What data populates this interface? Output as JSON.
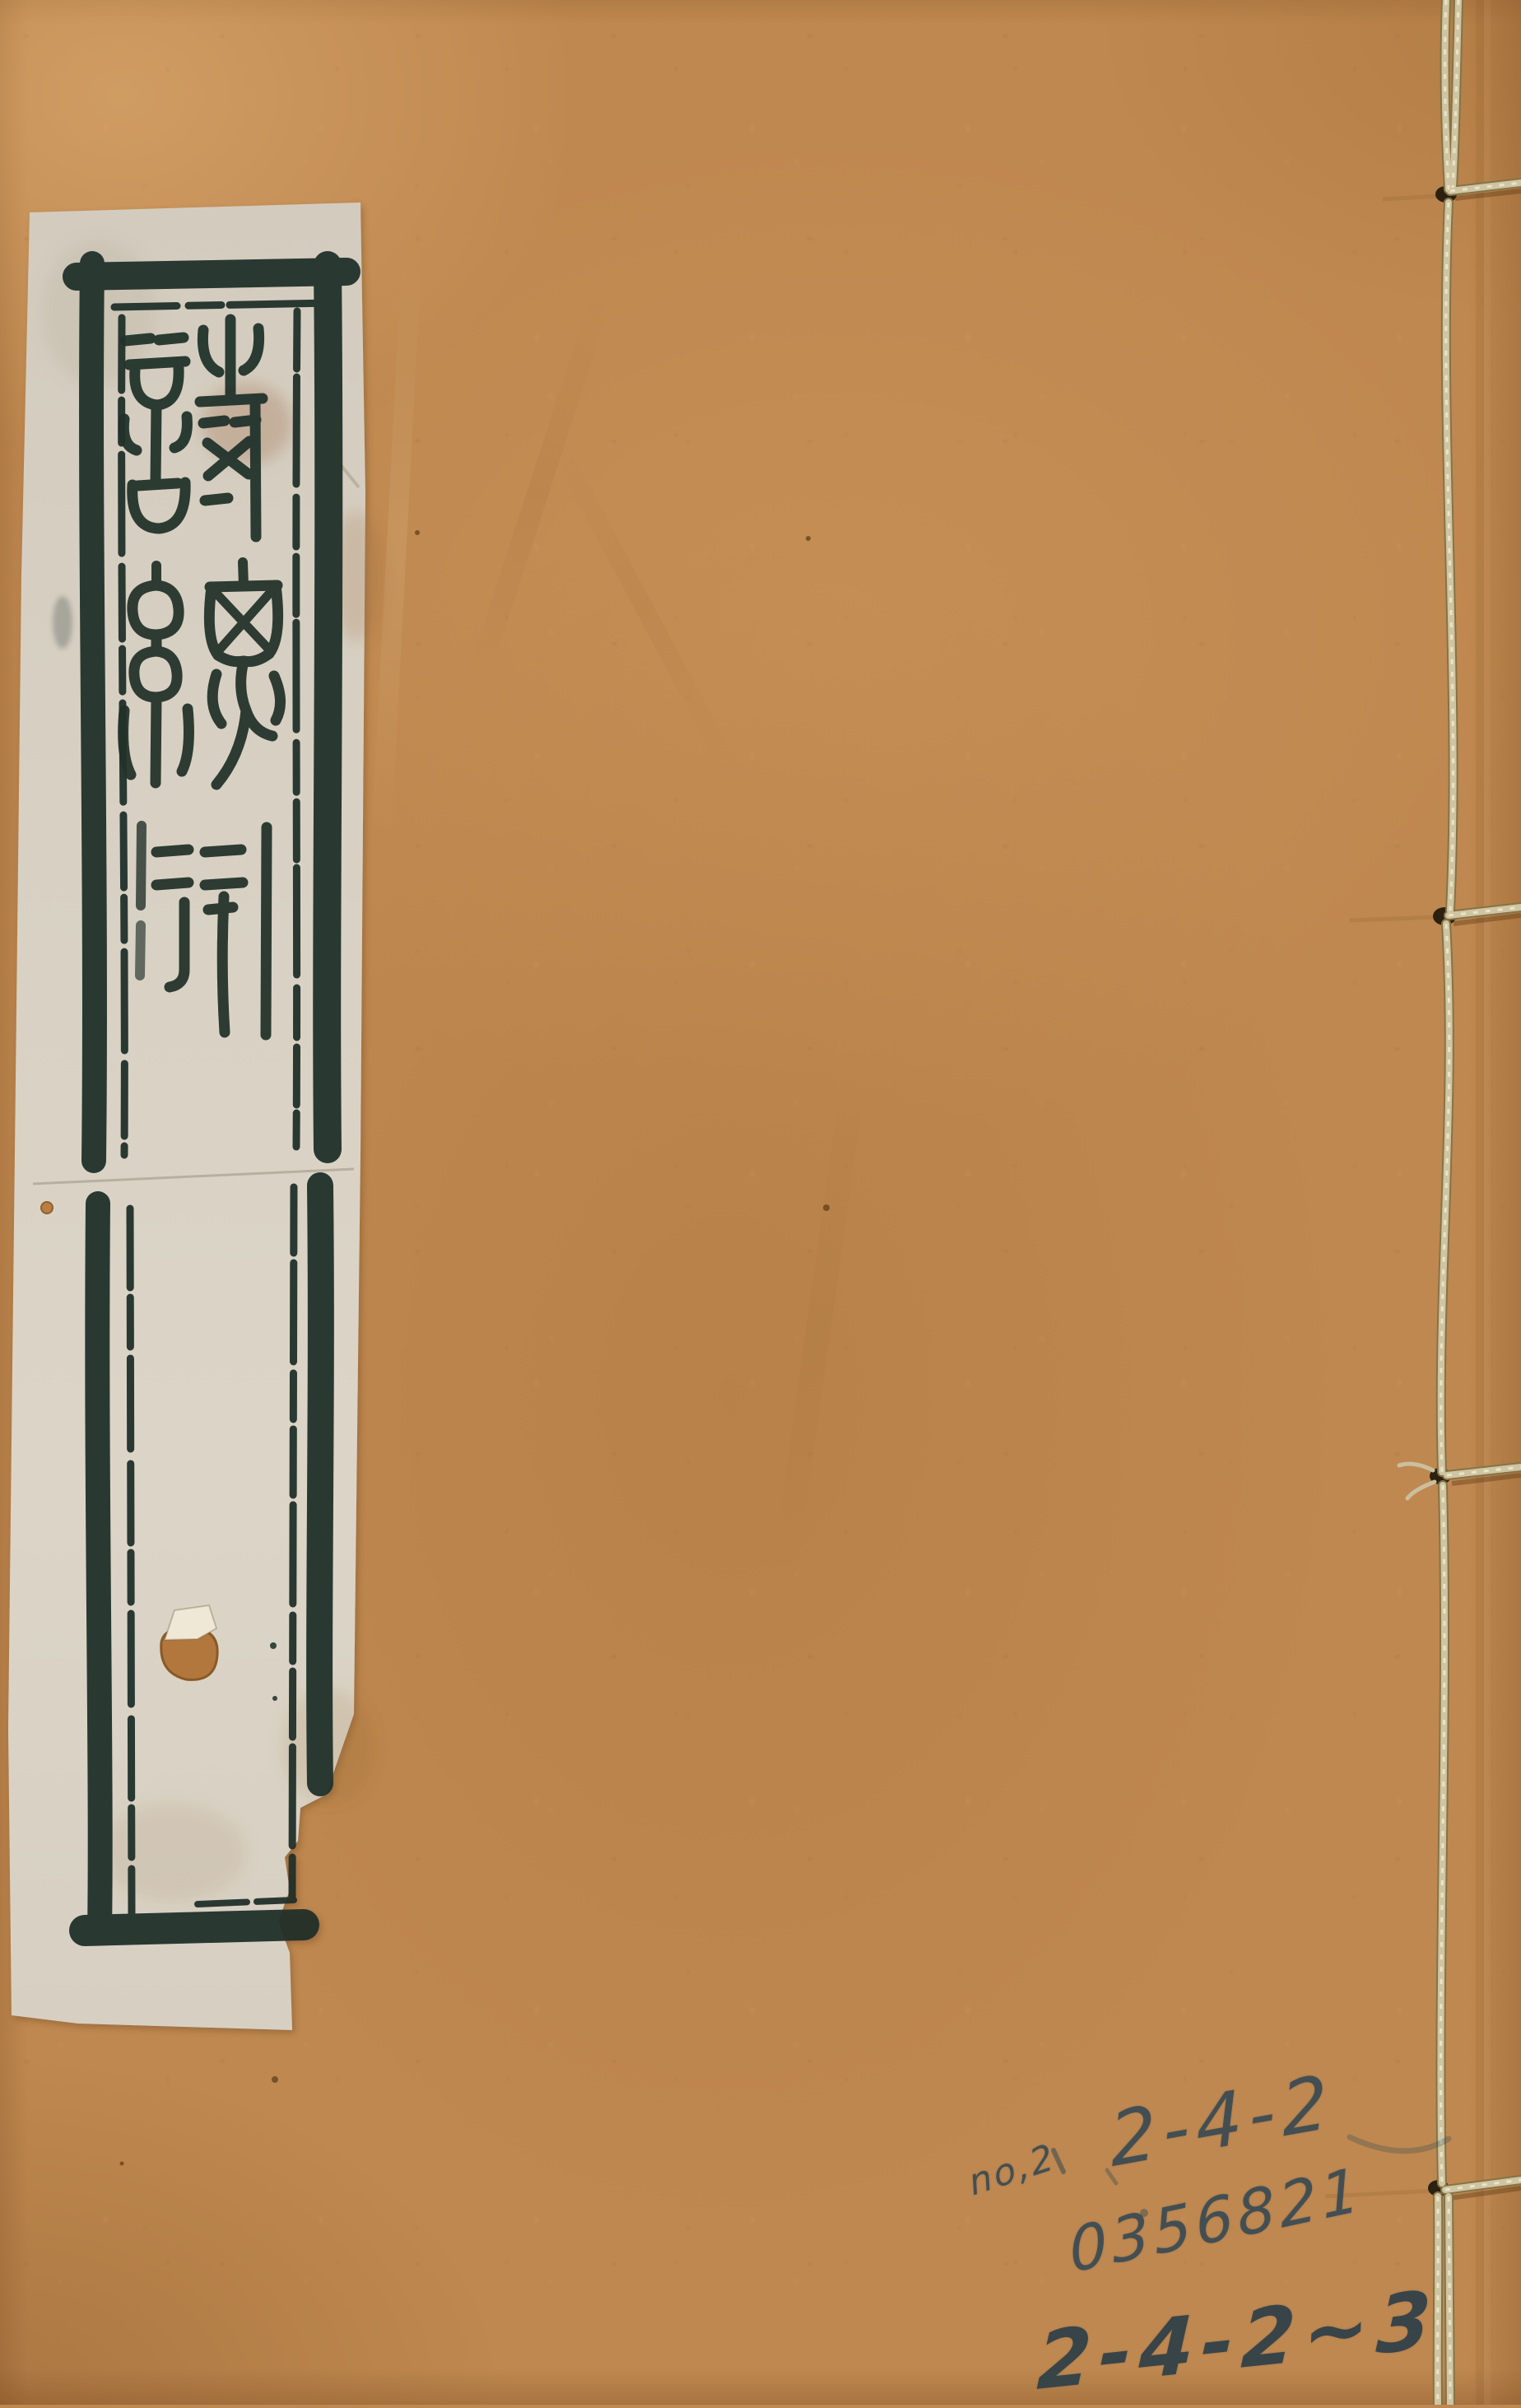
{
  "title_label": {
    "title": "詩總聞",
    "characters": [
      "詩",
      "總",
      "聞"
    ],
    "script": "seal script, vertical"
  },
  "pencil_annotations": {
    "library_no": "no,2",
    "shelf_mark_top": "2-4-2",
    "serial_number": "0356821",
    "shelf_mark_bottom": "2-4-2~3"
  },
  "colors": {
    "cover": "#bf8850",
    "cover_edge": "#9a6630",
    "label_paper": "#d9d2c4",
    "ink": "#23322b",
    "pencil": "#45565c",
    "thread": "#cfc5a4"
  }
}
